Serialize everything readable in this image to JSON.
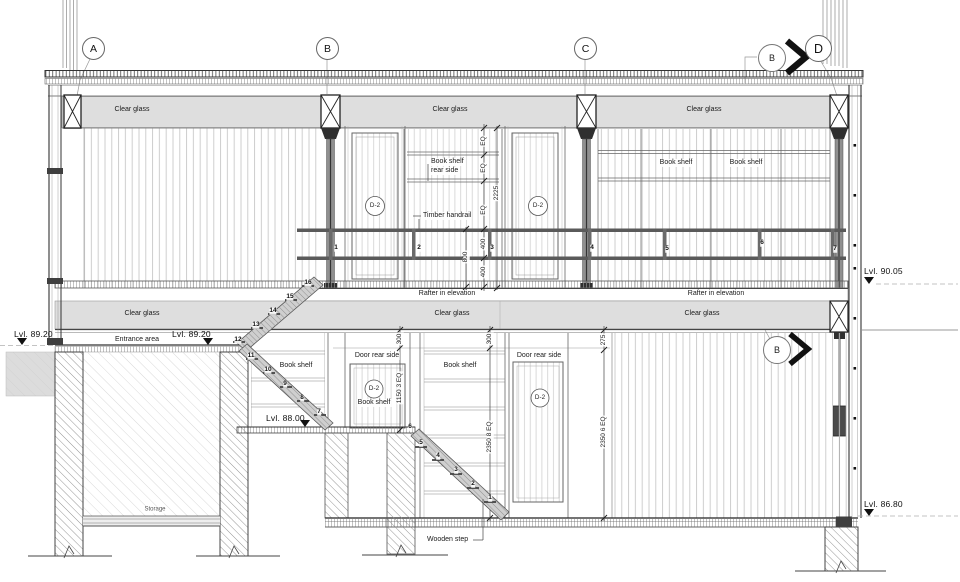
{
  "drawing": {
    "grids": {
      "a": "A",
      "b": "B",
      "c": "C",
      "d": "D"
    },
    "section_markers": {
      "top": "B",
      "mid": "B"
    },
    "levels": {
      "l9005": "Lvl. 90.05",
      "l8920": "Lvl. 89.20",
      "l8800": "Lvl. 88.00",
      "l8680": "Lvl. 86.80"
    },
    "labels": {
      "clear_glass": "Clear glass",
      "book_shelf": "Book shelf",
      "rear_side": "rear side",
      "timber_handrail": "Timber handrail",
      "rafter": "Rafter in elevation",
      "door_rear_side": "Door rear side",
      "entrance_area": "Entrance area",
      "storage": "Storage",
      "wooden_step": "Wooden step",
      "d2": "D-2"
    },
    "dims": {
      "eq": "EQ",
      "v2225": "2225",
      "v800": "800",
      "v400": "400",
      "v300": "300",
      "v275": "275",
      "v1150": "1150 3 EQ",
      "v2350_8": "2350 8 EQ",
      "v2350_6": "2350 6 EQ"
    },
    "posts": [
      "1",
      "2",
      "3",
      "4",
      "5",
      "6",
      "7"
    ],
    "steps_upper": [
      "16",
      "15",
      "14",
      "13",
      "12"
    ],
    "steps_mid": [
      "11",
      "10",
      "9",
      "8",
      "7"
    ],
    "steps_lower": [
      "6",
      "5",
      "4",
      "3",
      "2",
      "1"
    ]
  }
}
